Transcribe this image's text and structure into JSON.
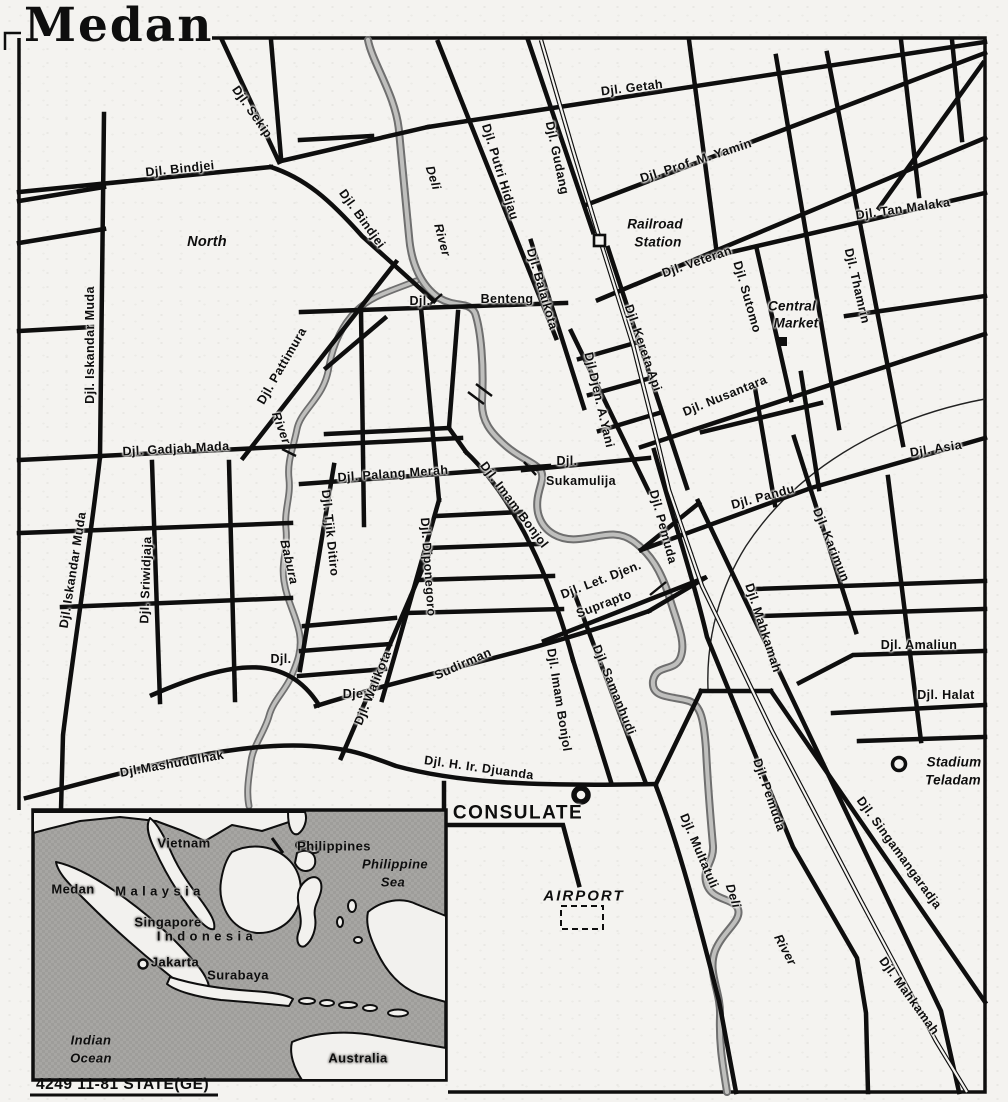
{
  "map": {
    "title": "Medan",
    "footer": "4249 11-81 STATE(GE)",
    "colors": {
      "paper": "#f4f3f0",
      "ink": "#0e0e0e",
      "river_gray": "#6f6f6f",
      "river_fill": "#bfbfbd",
      "inset_sea": "#a7a6a3",
      "inset_land": "#f2f1ee"
    },
    "markers": {
      "railroad_station": "open-square",
      "central_market": "filled-square",
      "consulate": "bold-open-circle",
      "stadium": "open-circle",
      "airport": "dashed-rectangle",
      "jakarta": "open-circle"
    },
    "streets": [
      "Djl. Sekip",
      "Djl. Bindjei",
      "Djl. Bindjei",
      "Djl. Getah",
      "Djl. Putri Hidjau",
      "Djl. Gudang",
      "Djl. Prof. M. Yamin",
      "Djl. Veteran",
      "Djl. Tan Malaka",
      "Djl. Thamrin",
      "Djl. Sutomo",
      "Djl. Iskandar Muda",
      "Djl. Iskandar Muda",
      "Djl. Gadjah Mada",
      "Djl. Pattimura",
      "Djl. Sriwidjaja",
      "Djl. Palang Merah",
      "Djl. Tjik Ditiro",
      "Djl. Diponegoro",
      "Djl. Imam Bonjol",
      "Djl. Imam Bonjol",
      "Djl.",
      "Benteng",
      "Djl. Balaikota",
      "Djl. Kereta Api",
      "Djl.Djen. A.Yani",
      "Djl. Nusantara",
      "Djl.",
      "Sukamulija",
      "Djl. Pemuda",
      "Djl. Pemuda",
      "Djl. Pandu",
      "Djl. Asia",
      "Djl. Karimun",
      "Djl. Mahkamah",
      "Djl. Mahkamah",
      "Djl. Amaliun",
      "Djl. Halat",
      "Djl. Singamangaradja",
      "Djl. Multatuli",
      "Sudirman",
      "Djen.",
      "Djl.",
      "Djl. Walikota",
      "Djl.Mashudulhak",
      "Djl. H. Ir. Djuanda",
      "Djl. Let. Djen.",
      "Suprapto",
      "Djl. Samanhudi"
    ],
    "rivers": [
      "Deli",
      "River",
      "River",
      "Babura",
      "Deli",
      "River"
    ],
    "places": [
      "North",
      "Railroad",
      "Station",
      "Central",
      "Market",
      "CONSULATE",
      "AIRPORT",
      "Stadium",
      "Teladam"
    ],
    "inset_labels": [
      "Vietnam",
      "Philippines",
      "Philippine",
      "Sea",
      "Medan",
      "M a l a y s i a",
      "Singapore",
      "I n d o n e s i a",
      "Jakarta",
      "Surabaya",
      "Indian",
      "Ocean",
      "Australia"
    ]
  }
}
